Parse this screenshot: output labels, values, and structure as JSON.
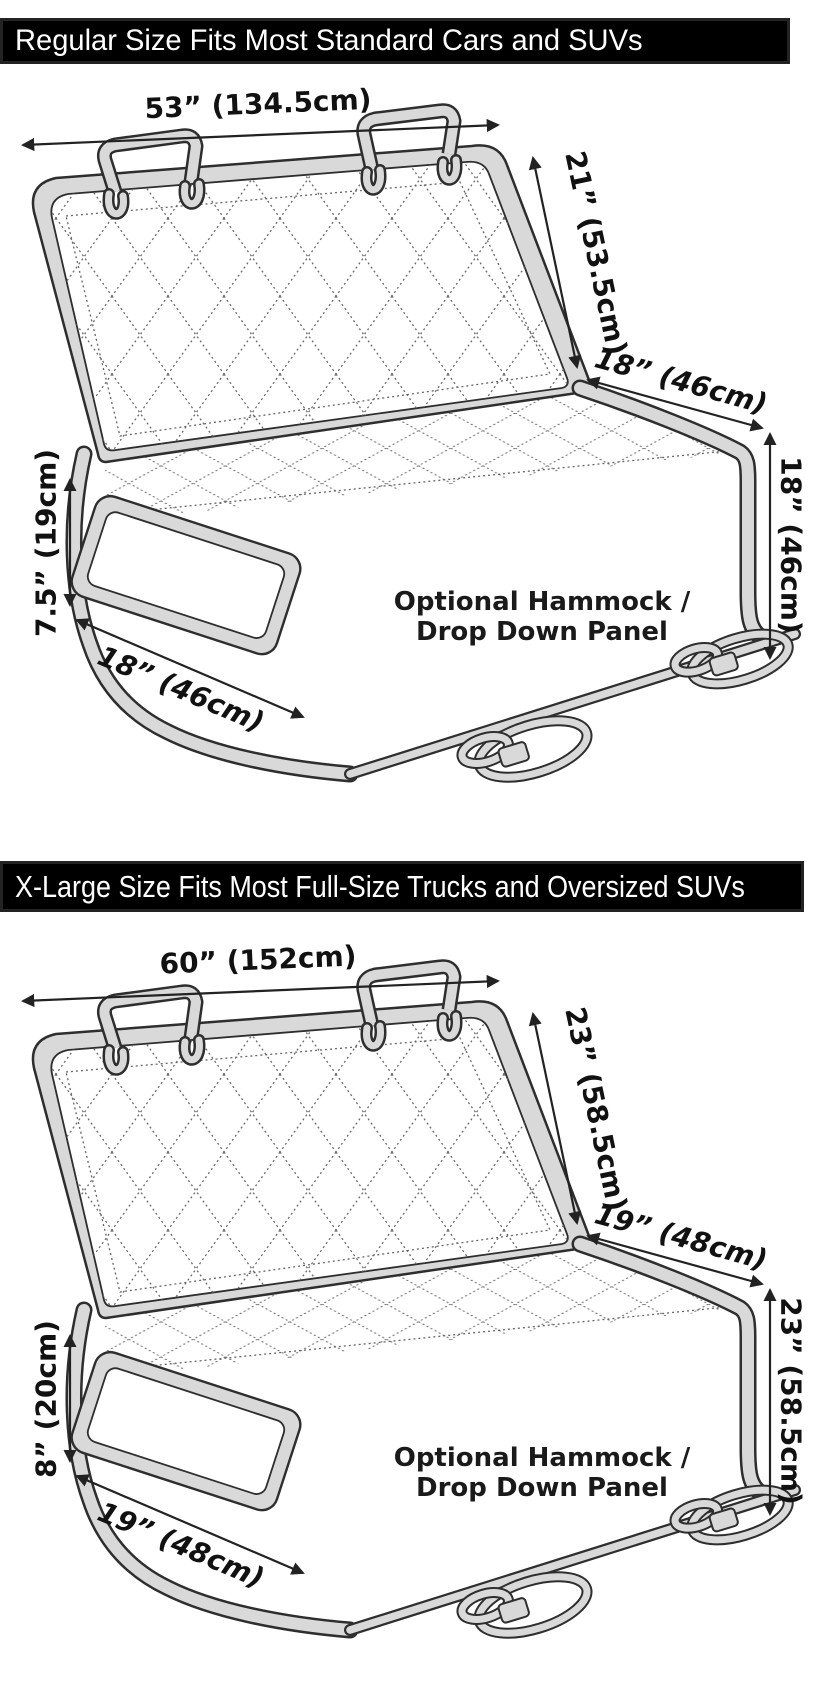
{
  "colors": {
    "banner_bg": "#000000",
    "banner_text": "#ffffff",
    "cover_fill": "#d9d9d9",
    "outline": "#2e2e2e",
    "dimension_text": "#111111"
  },
  "panels": [
    {
      "banner": "Regular Size Fits Most Standard Cars and SUVs",
      "width_label": "53” (134.5cm)",
      "back_height_label": "21” (53.5cm)",
      "seat_depth_label": "18” (46cm)",
      "drop_height_label": "18” (46cm)",
      "flap_height_label": "7.5” (19cm)",
      "flap_width_label": "18” (46cm)",
      "hammock_line1": "Optional Hammock /",
      "hammock_line2": "Drop Down Panel"
    },
    {
      "banner": "X-Large Size Fits Most Full-Size Trucks and Oversized SUVs",
      "width_label": "60” (152cm)",
      "back_height_label": "23” (58.5cm)",
      "seat_depth_label": "19” (48cm)",
      "drop_height_label": "23” (58.5cm)",
      "flap_height_label": "8” (20cm)",
      "flap_width_label": "19” (48cm)",
      "hammock_line1": "Optional Hammock /",
      "hammock_line2": "Drop Down Panel"
    }
  ]
}
